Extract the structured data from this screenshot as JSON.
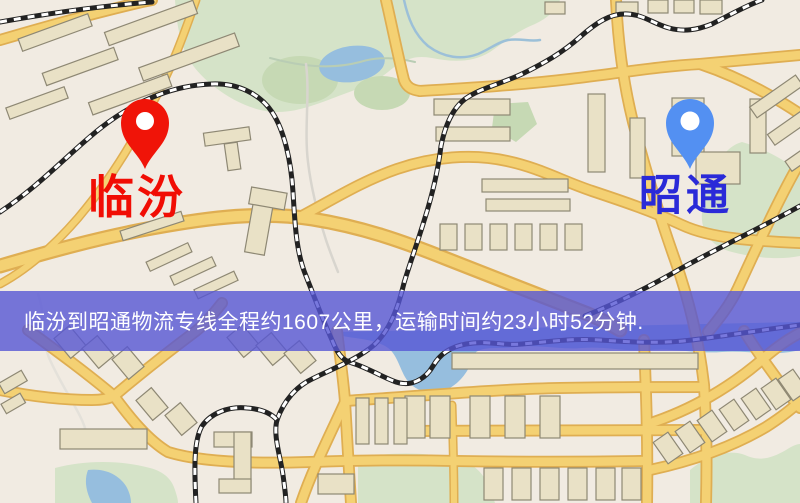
{
  "page": {
    "kind": "logistics-route-map",
    "width": 800,
    "height": 503
  },
  "banner": {
    "text": "临汾到昭通物流专线全程约1607公里，运输时间约23小时52分钟."
  },
  "route": {
    "origin": "临汾",
    "destination": "昭通",
    "distance": "约1607公里",
    "duration": "约23小时52分钟"
  },
  "markers": {
    "origin": {
      "label": "临汾",
      "pin": "red-map-pin"
    },
    "destination": {
      "label": "昭通",
      "pin": "blue-map-pin"
    }
  },
  "colors": {
    "origin-pin": "#f01408",
    "origin-label": "#f10d04",
    "dest-pin": "#5390f2",
    "dest-label": "#2a2ad8",
    "banner-bg": "#5656d4cc",
    "banner-text": "#ffffff",
    "map-bg": "#f1ebe2",
    "road": "#f4d173",
    "road-casing": "#dfae52",
    "park": "#d5e3c8",
    "water": "#96bede",
    "building": "#e9e1c6",
    "rail": "#222222"
  }
}
